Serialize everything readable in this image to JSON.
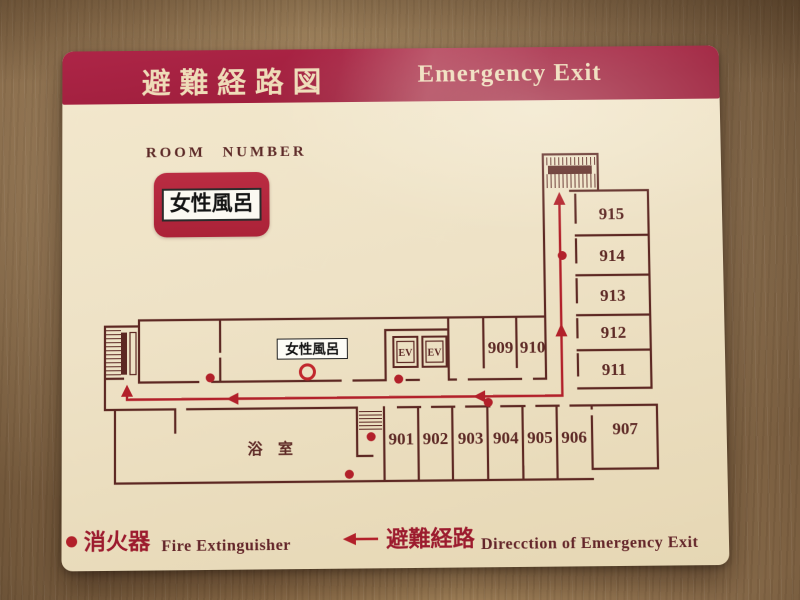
{
  "sign": {
    "title_jp": "避難経路図",
    "title_en": "Emergency Exit",
    "room_number_heading": "ROOM NUMBER",
    "current_room_badge": "女性風呂",
    "colors": {
      "title_bar_red": "#9e1e3c",
      "badge_red": "#b42a40",
      "sign_cream": "#efe3c8",
      "wall_maroon": "#5d2823",
      "route_red": "#b2202a"
    }
  },
  "plan": {
    "wing_rooms": [
      "915",
      "914",
      "913",
      "912",
      "911"
    ],
    "corridor_rooms": [
      "909",
      "910"
    ],
    "bottom_rooms": [
      "901",
      "902",
      "903",
      "904",
      "905",
      "906"
    ],
    "corner_room": "907",
    "bath_label": "浴 室",
    "women_bath_label": "女性風呂",
    "elevator_label": "EV"
  },
  "legend": {
    "items": [
      {
        "symbol": "fire-extinguisher-dot",
        "label_jp": "消火器",
        "label_en": "Fire Extinguisher"
      },
      {
        "symbol": "evacuation-route-arrow",
        "label_jp": "避難経路",
        "label_en": "Direcction of Emergency Exit"
      }
    ]
  }
}
